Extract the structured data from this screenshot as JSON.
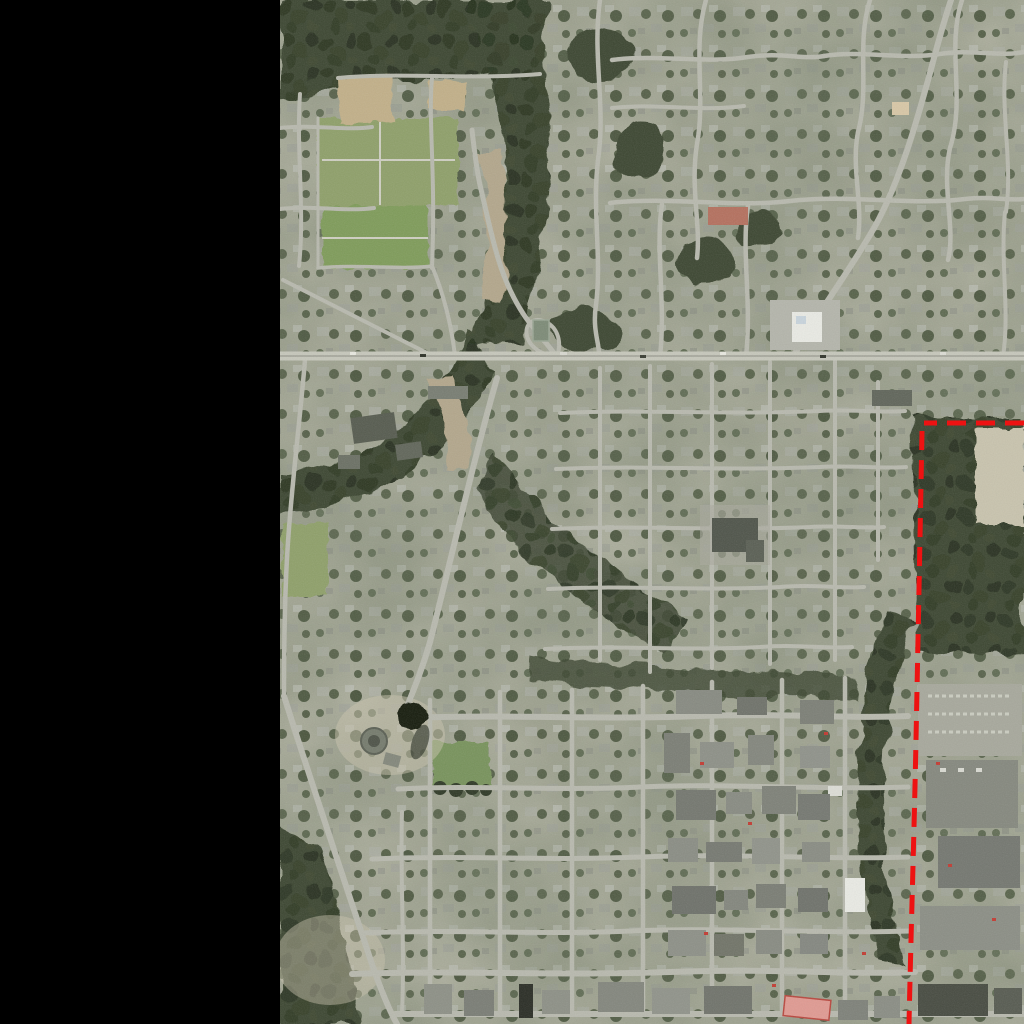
{
  "window": {
    "width_px": 1024,
    "height_px": 1024,
    "background": "#000000"
  },
  "left_panel": {
    "color": "#000000",
    "x": 0,
    "y": 0,
    "width_px": 280,
    "height_px": 1024
  },
  "map": {
    "kind": "aerial-photo",
    "description": "Aerial satellite photograph of a suburban town: east-west highway across the middle, forested creek ravine, ball-field parks at upper left, dense residential street grids, a commercial strip at lower right, with a red dashed boundary line overlay near the right edge",
    "palette": {
      "ground_base": "#a2a492",
      "ground_light": "#c9c4ae",
      "forest": "#3c4631",
      "forest_shadow": "#2b3523",
      "lawn": "#8fa06b",
      "sports_field": "#7f9c5a",
      "park_square": "#78935c",
      "dirt_field": "#c2b089",
      "gravel_wash": "#b3a78c",
      "road": "#b8b9ae",
      "highway": "#c6c7bb",
      "highway_median": "#98998e",
      "water_pond": "#171b11",
      "commercial_roof": "#84877e",
      "white_roof": "#e9eae4",
      "dark_roof": "#4f544a",
      "red_building_fill": "#e09a92",
      "red_building_edge": "#b8473e",
      "tennis_court": "#b4705e",
      "parking_lot": "#a7a89c",
      "car_red": "#c23b32"
    },
    "boundary_overlay": {
      "name": "red dashed boundary line",
      "color": "#ee1212",
      "stroke_width_px": 5,
      "dasharray": "19 10",
      "horizontal_segment": {
        "y": 423,
        "from_x": 924,
        "to_x": 1024
      },
      "vertical_segment": {
        "top": [
          922,
          431
        ],
        "mid": [
          916,
          760
        ],
        "bottom": [
          909,
          1024
        ]
      }
    }
  }
}
